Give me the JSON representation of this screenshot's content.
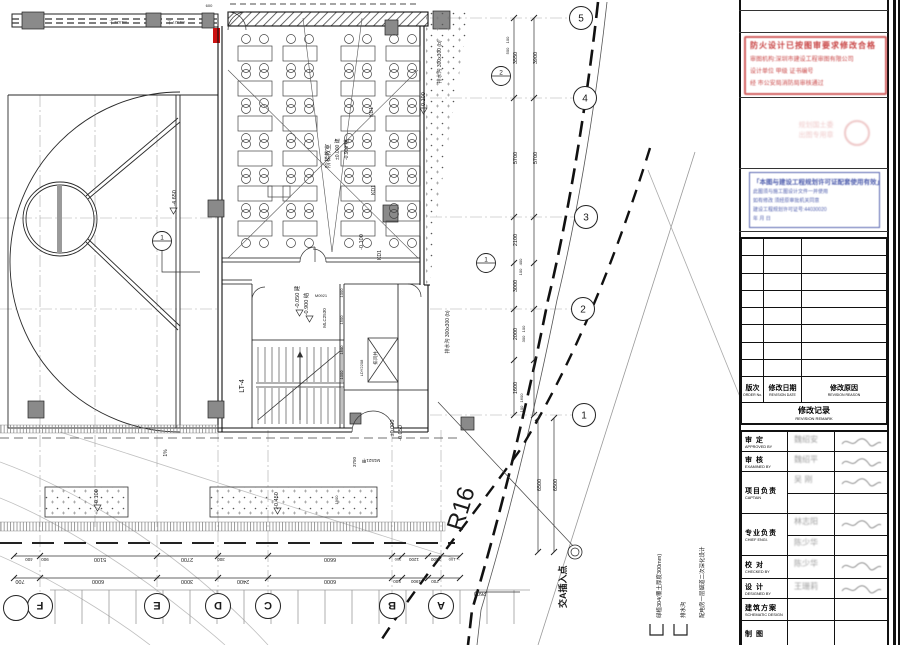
{
  "plan": {
    "room": {
      "name": "阶梯教室",
      "elev_arch": "±0.000 建",
      "elev_struct": "-0.900 结"
    },
    "classroom": {
      "rows": 6,
      "cols": 4
    },
    "road_label": "R16",
    "insert_label": "交A插入点",
    "slope_label": "1%",
    "court_elev": "-4.650",
    "dims": [
      {
        "t": "700",
        "x": 20,
        "y": 580,
        "r": 180
      },
      {
        "t": "6000",
        "x": 98,
        "y": 580,
        "r": 180
      },
      {
        "t": "3000",
        "x": 187,
        "y": 580,
        "r": 180
      },
      {
        "t": "2400",
        "x": 243,
        "y": 580,
        "r": 180
      },
      {
        "t": "6000",
        "x": 330,
        "y": 580,
        "r": 180
      },
      {
        "t": "500",
        "x": 397,
        "y": 580,
        "r": 180,
        "s": 4.5
      },
      {
        "t": "1900",
        "x": 416,
        "y": 580,
        "r": 180,
        "s": 4.5
      },
      {
        "t": "700",
        "x": 435,
        "y": 580,
        "r": 180,
        "s": 4.5
      },
      {
        "t": "2600",
        "x": 480,
        "y": 592,
        "r": 180
      },
      {
        "t": "400",
        "x": 29,
        "y": 558,
        "r": 180,
        "s": 4.5
      },
      {
        "t": "900",
        "x": 45,
        "y": 558,
        "r": 180,
        "s": 4.5
      },
      {
        "t": "5100",
        "x": 100,
        "y": 558,
        "r": 180
      },
      {
        "t": "2700",
        "x": 187,
        "y": 558,
        "r": 180
      },
      {
        "t": "300",
        "x": 221,
        "y": 558,
        "r": 180,
        "s": 4.5
      },
      {
        "t": "6600",
        "x": 330,
        "y": 558,
        "r": 180
      },
      {
        "t": "300",
        "x": 398,
        "y": 558,
        "r": 180,
        "s": 4
      },
      {
        "t": "1200",
        "x": 414,
        "y": 558,
        "r": 180,
        "s": 4.5
      },
      {
        "t": "2500",
        "x": 436,
        "y": 558,
        "r": 180,
        "s": 4.5
      },
      {
        "t": "100",
        "x": 452,
        "y": 558,
        "r": 180,
        "s": 4
      },
      {
        "t": "3550",
        "x": 517,
        "y": 58,
        "r": -90
      },
      {
        "t": "5700",
        "x": 517,
        "y": 158,
        "r": -90
      },
      {
        "t": "2100",
        "x": 517,
        "y": 240,
        "r": -90
      },
      {
        "t": "3000",
        "x": 517,
        "y": 286,
        "r": -90
      },
      {
        "t": "2000",
        "x": 517,
        "y": 334,
        "r": -90
      },
      {
        "t": "1600",
        "x": 517,
        "y": 388,
        "r": -90
      },
      {
        "t": "3900",
        "x": 537,
        "y": 58,
        "r": -90
      },
      {
        "t": "5700",
        "x": 537,
        "y": 158,
        "r": -90
      },
      {
        "t": "6500",
        "x": 541,
        "y": 485,
        "r": -90
      },
      {
        "t": "6500",
        "x": 557,
        "y": 485,
        "r": -90
      },
      {
        "t": "100",
        "x": 509,
        "y": 40,
        "r": -90,
        "s": 4
      },
      {
        "t": "500",
        "x": 509,
        "y": 51,
        "r": -90,
        "s": 4
      },
      {
        "t": "400",
        "x": 522,
        "y": 262,
        "r": -90,
        "s": 4
      },
      {
        "t": "100",
        "x": 522,
        "y": 272,
        "r": -90,
        "s": 4
      },
      {
        "t": "100",
        "x": 525,
        "y": 329,
        "r": -90,
        "s": 4
      },
      {
        "t": "300",
        "x": 525,
        "y": 339,
        "r": -90,
        "s": 4
      },
      {
        "t": "1600",
        "x": 523,
        "y": 398,
        "r": -90,
        "s": 4
      },
      {
        "t": "100",
        "x": 523,
        "y": 409,
        "r": -90,
        "s": 4
      },
      {
        "t": "3750",
        "x": 356,
        "y": 462,
        "r": -90,
        "s": 4.5
      },
      {
        "t": "1000",
        "x": 343,
        "y": 293,
        "r": -90,
        "s": 4
      },
      {
        "t": "1500",
        "x": 343,
        "y": 320,
        "r": -90,
        "s": 4
      },
      {
        "t": "1500",
        "x": 343,
        "y": 350,
        "r": -90,
        "s": 4
      },
      {
        "t": "1000",
        "x": 343,
        "y": 375,
        "r": -90,
        "s": 4
      },
      {
        "t": "1900",
        "x": 338,
        "y": 500,
        "r": -90,
        "s": 4
      },
      {
        "t": "600",
        "x": 209,
        "y": 7,
        "r": 0,
        "s": 4
      }
    ],
    "elevations": [
      {
        "t": "-4.650",
        "x": 176,
        "y": 198,
        "r": -90
      },
      {
        "t": "-0.050 建",
        "x": 299,
        "y": 297,
        "r": -90
      },
      {
        "t": "-0.900 结",
        "x": 308,
        "y": 304,
        "r": -90
      },
      {
        "t": "-0.100",
        "x": 425,
        "y": 100,
        "r": -90
      },
      {
        "t": "-0.100",
        "x": 98,
        "y": 497,
        "r": -90
      },
      {
        "t": "-0.450",
        "x": 278,
        "y": 500,
        "r": -90
      },
      {
        "t": "±0.000",
        "x": 394,
        "y": 428,
        "r": -90
      },
      {
        "t": "-0.050",
        "x": 402,
        "y": 433,
        "r": -90
      },
      {
        "t": "-0.100",
        "x": 363,
        "y": 242,
        "r": -90
      }
    ],
    "tags": [
      {
        "t": "KD1",
        "x": 373,
        "y": 112,
        "r": -90,
        "s": 5
      },
      {
        "t": "KD1",
        "x": 375,
        "y": 190,
        "r": -90,
        "s": 5
      },
      {
        "t": "KD1",
        "x": 381,
        "y": 255,
        "r": -90,
        "s": 5
      },
      {
        "t": "LT-4",
        "x": 244,
        "y": 386,
        "r": -90,
        "s": 7
      },
      {
        "t": "MLC2530",
        "x": 326,
        "y": 318,
        "r": -90,
        "s": 4.5
      },
      {
        "t": "LDY2208",
        "x": 363,
        "y": 368,
        "r": -90,
        "s": 4
      },
      {
        "t": "排风井",
        "x": 377,
        "y": 358,
        "r": -90,
        "s": 4.5
      },
      {
        "t": "M1521甲",
        "x": 371,
        "y": 459,
        "r": 180,
        "s": 4.5
      },
      {
        "t": "M0921",
        "x": 321,
        "y": 297,
        "r": 0,
        "s": 4
      },
      {
        "t": "排水沟 300x300 (b)",
        "x": 441,
        "y": 62,
        "r": -90,
        "s": 5
      },
      {
        "t": "排水沟 300x300 (b)",
        "x": 449,
        "y": 332,
        "r": -90,
        "s": 5
      },
      {
        "t": "1%",
        "x": 167,
        "y": 453,
        "r": -90,
        "s": 5
      },
      {
        "t": "M1524 上",
        "x": 118,
        "y": 21,
        "r": 180,
        "s": 4
      },
      {
        "t": "M1527 上",
        "x": 176,
        "y": 21,
        "r": 180,
        "s": 4
      }
    ],
    "grid_letters": [
      {
        "t": "F",
        "x": 40
      },
      {
        "t": "E",
        "x": 157
      },
      {
        "t": "D",
        "x": 218
      },
      {
        "t": "C",
        "x": 268
      },
      {
        "t": "B",
        "x": 392
      },
      {
        "t": "A",
        "x": 441
      }
    ],
    "grid_numbers": [
      {
        "t": "5",
        "x": 581,
        "y": 18
      },
      {
        "t": "4",
        "x": 585,
        "y": 98
      },
      {
        "t": "3",
        "x": 586,
        "y": 217
      },
      {
        "t": "2",
        "x": 583,
        "y": 309
      },
      {
        "t": "1",
        "x": 584,
        "y": 415
      }
    ],
    "detail_markers": [
      {
        "t": "2",
        "x": 501,
        "y": 76
      },
      {
        "t": "1",
        "x": 486,
        "y": 263
      },
      {
        "t": "1",
        "x": 162,
        "y": 241
      }
    ],
    "legend": [
      {
        "t": "绿植304(覆土厚度300mm)",
        "x": 661,
        "sq": true
      },
      {
        "t": "排水沟",
        "x": 685,
        "sq": true
      },
      {
        "t": "配电房一层烟道二次深化设计",
        "x": 704,
        "sq": false
      }
    ]
  },
  "panel": {
    "stamps": {
      "red": [
        "防火设计已按图审要求修改合格",
        "审图机构:深圳市建设工程审图有限公司",
        "设计单位 甲级 证书编号",
        "经 市公安局消防局审核通过"
      ],
      "faint": [
        "规划国土委",
        "出图专用章"
      ],
      "blue": [
        "「本图与建设工程规划许可证配套使用有效」",
        "此图须与施工图设计文件一并使用",
        "如有修改 须经原审批机关同意",
        "建设工程规划许可证号:44030020",
        "年      月      日"
      ]
    },
    "revision": {
      "rows": 8,
      "col1_cn": "版次",
      "col1_en": "ORDER No.",
      "col2_cn": "修改日期",
      "col2_en": "REVISION DATE",
      "col3_cn": "修改原因",
      "col3_en": "REVISION REASON",
      "footer_cn": "修改记录",
      "footer_en": "REVISION REMARK"
    },
    "approval": {
      "rows": [
        {
          "cn": "审 定",
          "en": "APPROVED BY",
          "name": "魏绍安",
          "name2": "",
          "sig": true,
          "split": false
        },
        {
          "cn": "审 核",
          "en": "EXAMINED BY",
          "name": "魏绍平",
          "name2": "",
          "sig": true,
          "split": false
        },
        {
          "cn": "项目负责",
          "en": "CAPTAIN",
          "name": "吴 刚",
          "name2": "",
          "sig": true,
          "split": true
        },
        {
          "cn": "专业负责",
          "en": "CHIEF ENGI.",
          "name": "林志阳",
          "name2": "陈少华",
          "sig": true,
          "split": true
        },
        {
          "cn": "校 对",
          "en": "CHECKED BY",
          "name": "陈少华",
          "name2": "",
          "sig": true,
          "split": false
        },
        {
          "cn": "设 计",
          "en": "DESIGNED BY",
          "name": "王珊莉",
          "name2": "",
          "sig": true,
          "split": false
        },
        {
          "cn": "建筑方案",
          "en": "SCHEMATIC DESIGN",
          "name": "",
          "name2": "",
          "sig": false,
          "split": false
        },
        {
          "cn": "制 图",
          "en": "",
          "name": "",
          "name2": "",
          "sig": false,
          "split": false
        }
      ]
    }
  }
}
